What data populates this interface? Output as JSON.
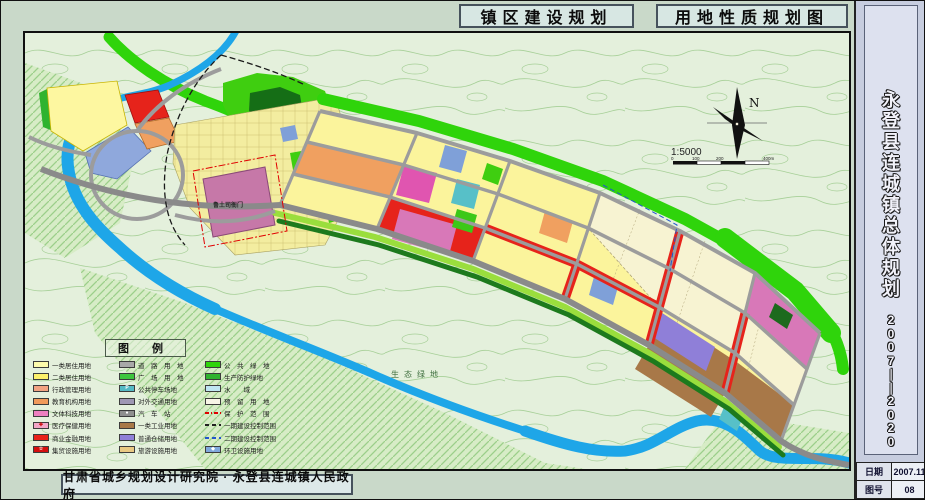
{
  "titles": {
    "left": "镇区建设规划",
    "right": "用地性质规划图"
  },
  "sidebar": {
    "title": "永登县连城镇总体规划",
    "years": "2007——2020",
    "info": [
      {
        "label": "日期",
        "value": "2007.11"
      },
      {
        "label": "图号",
        "value": "08"
      }
    ]
  },
  "footer": {
    "credit": "甘肃省城乡规划设计研究院 · 永登县连城镇人民政府"
  },
  "map": {
    "compass_label": "N",
    "scale_text": "1:5000",
    "scale_ticks": [
      "0",
      "100",
      "200",
      "400m"
    ],
    "labels": [
      {
        "text": "鲁土司衙门"
      },
      {
        "text": "生态绿地"
      }
    ]
  },
  "legend": {
    "title": "图 例",
    "columns": [
      {
        "items": [
          {
            "label": "一类居住用地",
            "kind": "fill",
            "color": "#fdfbac"
          },
          {
            "label": "二类居住用地",
            "kind": "fill",
            "color": "#fcf06a"
          },
          {
            "label": "行政管理用地",
            "kind": "fill",
            "color": "#f2a382"
          },
          {
            "label": "教育机构用地",
            "kind": "fill",
            "color": "#f09a5a"
          },
          {
            "label": "文体科技用地",
            "kind": "fill",
            "color": "#ee7fc0"
          },
          {
            "label": "医疗保健用地",
            "kind": "fill",
            "color": "#f2a6c6",
            "symbol": "✚",
            "symbolColor": "#cc0000"
          },
          {
            "label": "商业金融用地",
            "kind": "fill",
            "color": "#e8221a"
          },
          {
            "label": "集贸设施用地",
            "kind": "fill",
            "color": "#d40f0f",
            "symbol": "☆",
            "symbolColor": "#ffffff"
          }
        ]
      },
      {
        "items": [
          {
            "label": "道　路　用　地",
            "kind": "fill",
            "color": "#a8a8a8"
          },
          {
            "label": "广　场　用　地",
            "kind": "fill",
            "color": "#3ec63e"
          },
          {
            "label": "公共停车场地",
            "kind": "fill",
            "color": "#55b9c5",
            "symbol": "P",
            "symbolColor": "#ffffff"
          },
          {
            "label": "对外交通用地",
            "kind": "fill",
            "color": "#9e97b4"
          },
          {
            "label": "汽　车　站",
            "kind": "fill",
            "color": "#8f8f8f",
            "symbol": "●",
            "symbolColor": "#ffffff"
          },
          {
            "label": "一类工业用地",
            "kind": "fill",
            "color": "#a87848"
          },
          {
            "label": "普通仓储用地",
            "kind": "fill",
            "color": "#8f7fd8"
          },
          {
            "label": "旅游设施用地",
            "kind": "fill",
            "color": "#e9c983"
          }
        ]
      },
      {
        "items": [
          {
            "label": "公　共　绿　地",
            "kind": "fill",
            "color": "#2fd40b"
          },
          {
            "label": "生产防护绿地",
            "kind": "fill",
            "color": "#2fb32f"
          },
          {
            "label": "水　　域",
            "kind": "fill",
            "color": "#bfe6f2"
          },
          {
            "label": "预　留　用　地",
            "kind": "fill",
            "color": "#f7f5e6"
          },
          {
            "label": "保　护　范　围",
            "kind": "line-dashdot",
            "color": "#e00000"
          },
          {
            "label": "一期建设控制范围",
            "kind": "line-dash",
            "color": "#222222"
          },
          {
            "label": "二期建设控制范围",
            "kind": "line-dash",
            "color": "#2255cc"
          },
          {
            "label": "环卫设施用地",
            "kind": "fill",
            "color": "#7fa8dc",
            "symbol": "◆",
            "symbolColor": "#ffffff"
          }
        ]
      }
    ]
  },
  "colors": {
    "river": "#1ea6e8",
    "road": "#9c9c9c",
    "residential": "#fbf49c",
    "commercial": "#e6231b",
    "industry": "#a87848",
    "green_public": "#2fd40b",
    "map_background": "#e4f0dc"
  }
}
